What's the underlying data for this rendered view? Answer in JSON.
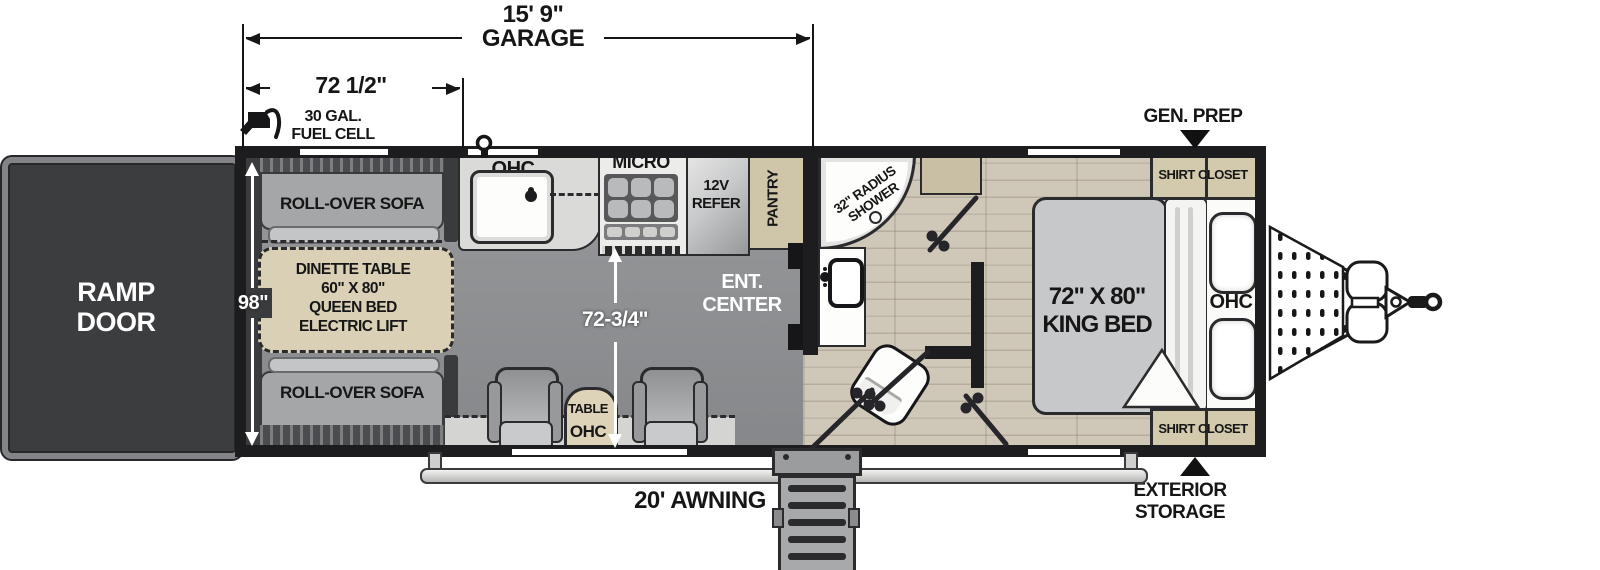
{
  "dims": {
    "garage_len": "15' 9\"",
    "garage_word": "GARAGE",
    "sofa_len": "72 1/2\"",
    "body_width": "98\"",
    "garage_interior": "72-3/4\""
  },
  "exterior": {
    "ramp_line1": "RAMP",
    "ramp_line2": "DOOR",
    "fuel_line1": "30 GAL.",
    "fuel_line2": "FUEL CELL",
    "gen_prep": "GEN. PREP",
    "awning": "20' AWNING",
    "storage_line1": "EXTERIOR",
    "storage_line2": "STORAGE"
  },
  "garage": {
    "sofa_top": "ROLL-OVER SOFA",
    "sofa_bottom": "ROLL-OVER SOFA",
    "dinette_line1": "DINETTE TABLE",
    "dinette_line2": "60\" X 80\"",
    "dinette_line3": "QUEEN BED",
    "dinette_line4": "ELECTRIC LIFT",
    "kitchen_ohc": "OHC",
    "micro": "MICRO",
    "refer_line1": "12V",
    "refer_line2": "REFER",
    "pantry": "PANTRY",
    "ent_line1": "ENT.",
    "ent_line2": "CENTER",
    "table": "TABLE",
    "rear_ohc": "OHC"
  },
  "bath": {
    "shower_line1": "32\" RADIUS",
    "shower_line2": "SHOWER"
  },
  "bedroom": {
    "bed_line1": "72\" X 80\"",
    "bed_line2": "KING BED",
    "ohc": "OHC",
    "closet_top": "SHIRT CLOSET",
    "closet_bottom": "SHIRT CLOSET"
  },
  "colors": {
    "wall": "#1d1d1f",
    "garage_floor": "#8f9193",
    "wood_floor": "#cfc8b9",
    "tan": "#d9d0b5",
    "ramp_door": "#3c3d3f",
    "dimension_white": "#ffffff"
  },
  "icons": {
    "fuel-nozzle-icon": "gas pump nozzle",
    "gen-prep-arrow-icon": "down triangle marker",
    "exterior-storage-arrow-icon": "up triangle marker",
    "water-port-icon": "exterior spray port",
    "door-swing-icon": "door swing with handle"
  }
}
